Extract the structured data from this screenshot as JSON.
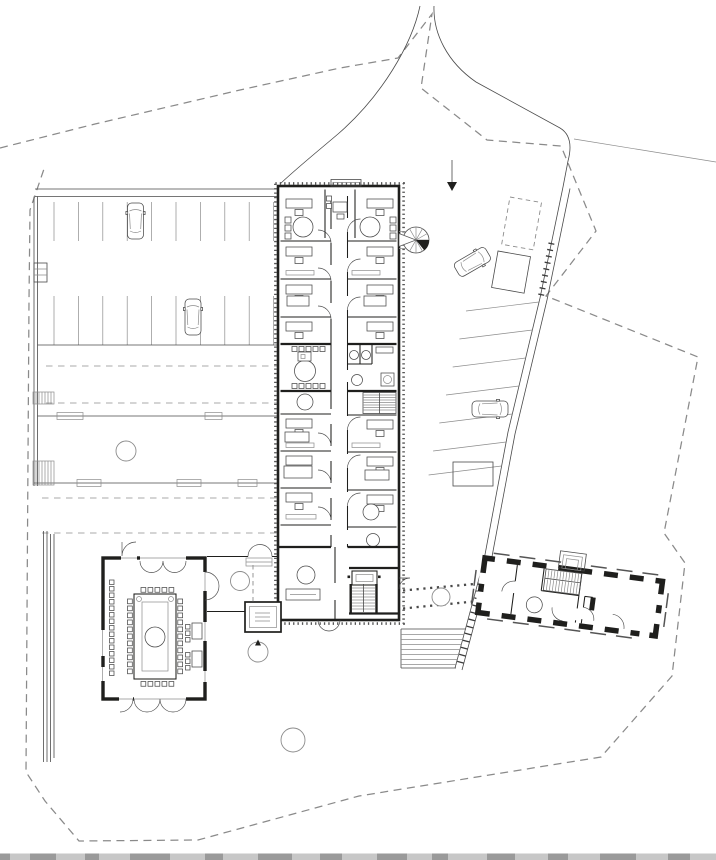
{
  "colors": {
    "bg": "#ffffff",
    "ink": "#1f1f1d",
    "medium": "#4a4a4a",
    "light": "#8c8c8c",
    "boundary": "#8a8a8a",
    "strip": "#c7c7c7",
    "stripdark": "#9a9a9a"
  },
  "drawing": {
    "style": "black and white architectural line drawing, no text labels",
    "site_boundary": "irregular dashed polygon around whole site",
    "buildings": [
      {
        "id": "office-building",
        "shape": "long vertical double-loaded bar with central corridor, offices both sides, service core mid, stairs and lift south, spiral stair on east face"
      },
      {
        "id": "assembly-hall",
        "shape": "square hall south-west with rectangular council table ring, perimeter chairs and bench row"
      },
      {
        "id": "existing-building",
        "shape": "rotated rectangle south-east with thick black masonry walls, window openings, central stair"
      }
    ],
    "site_elements": {
      "parking_rows": 2,
      "parking_stall_lines_per_row": 10,
      "angled_stalls_along_service_road": 7,
      "cars": 4,
      "trees": 5,
      "driveway_dashed_centerlines": 4,
      "garden_stair_flights": 3,
      "dotted_footpath_lines": 2,
      "direction_arrow": "downward arrow on access road"
    }
  }
}
